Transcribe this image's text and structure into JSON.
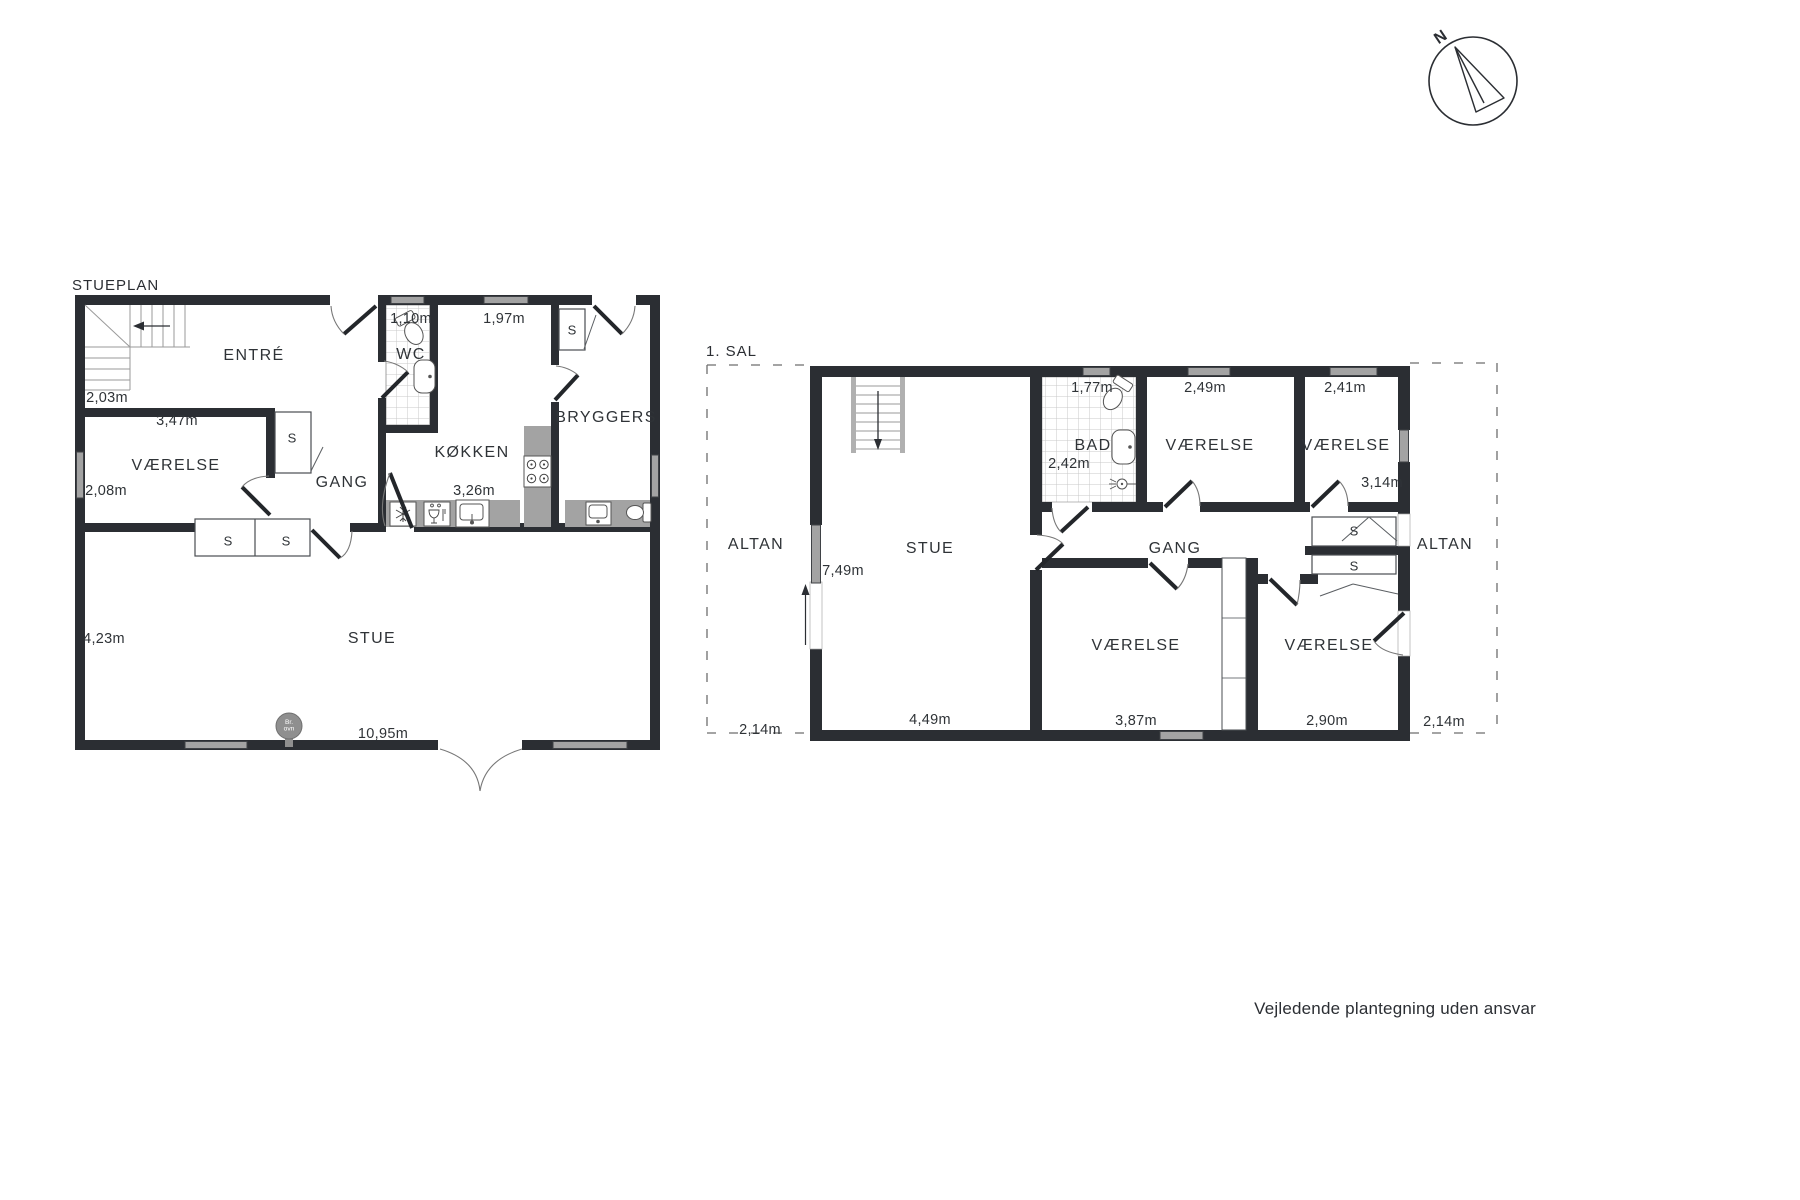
{
  "footer": "Vejledende plantegning uden ansvar",
  "compass": {
    "north": "N"
  },
  "stueplan": {
    "title": "STUEPLAN",
    "rooms": {
      "entre": "ENTRÉ",
      "vaerelse": "VÆRELSE",
      "gang": "GANG",
      "wc": "WC",
      "kokken": "KØKKEN",
      "bryggers": "BRYGGERS",
      "stue": "STUE"
    },
    "closet": "S",
    "stove": {
      "line1": "Br.",
      "line2": "ovn"
    },
    "dims": {
      "stairs": "2,03m",
      "vaerelse_width": "3,47m",
      "vaerelse_height": "2,08m",
      "wc_width": "1,10m",
      "window_width": "1,97m",
      "kokken_width": "3,26m",
      "stue_height": "4,23m",
      "stue_width": "10,95m"
    }
  },
  "sal1": {
    "title": "1. SAL",
    "rooms": {
      "stue": "STUE",
      "bad": "BAD",
      "gang": "GANG",
      "vaerelse": "VÆRELSE",
      "altan": "ALTAN"
    },
    "closet": "S",
    "dims": {
      "stue_height": "7,49m",
      "stue_width": "4,49m",
      "bad_window": "1,77m",
      "bad_width": "2,42m",
      "vaerelse_top_mid": "2,49m",
      "vaerelse_top_right": "2,41m",
      "vaerelse_right_height": "3,14m",
      "vaerelse_bottom_mid": "3,87m",
      "vaerelse_bottom_right": "2,90m",
      "altan_left": "2,14m",
      "altan_right": "2,14m"
    }
  }
}
